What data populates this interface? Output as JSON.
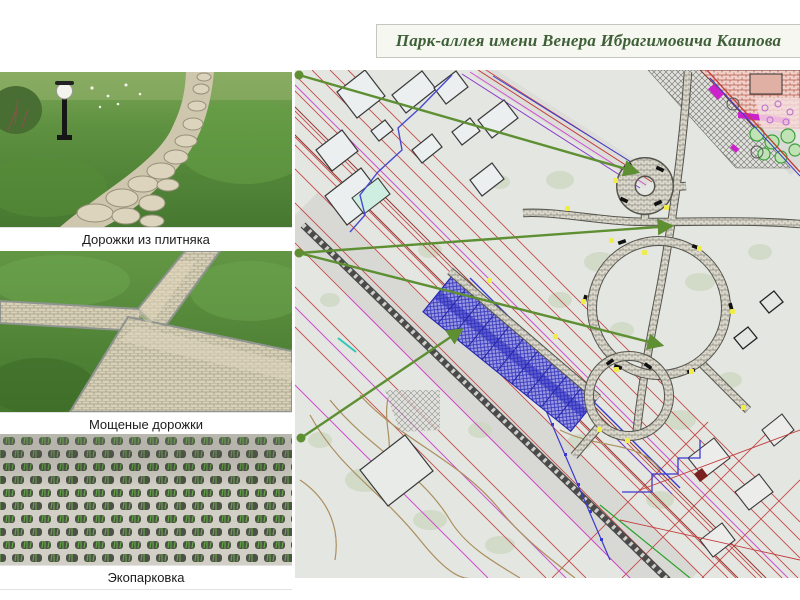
{
  "title": {
    "text": "Парк-аллея имени Венера Ибрагимовича Каипова"
  },
  "photos": [
    {
      "caption": "Дорожки из плитняка"
    },
    {
      "caption": "Мощеные дорожки"
    },
    {
      "caption": "Экопарковка"
    }
  ],
  "colors": {
    "title_green": "#3e5f38",
    "connector_green": "#5e8f33",
    "parking_blue": "#4242c8",
    "cad_red": "#c23b3b",
    "cad_magenta": "#cf4fcf",
    "cad_blue": "#3b3bd0",
    "map_background": "#e4e6e1"
  }
}
